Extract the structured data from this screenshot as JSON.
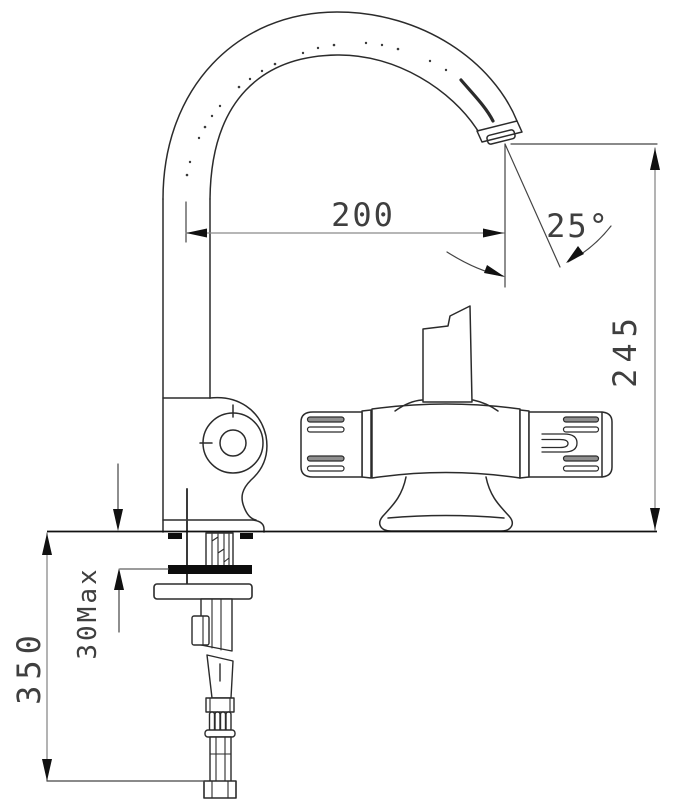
{
  "drawing": {
    "type": "technical-dimension-drawing",
    "subject": "gooseneck kitchen faucet with thermostatic mixer body, side elevation",
    "background_color": "#ffffff",
    "line_color": "#2b2b2b",
    "dimension_line_color": "#8a8a8a",
    "arrow_color": "#111111",
    "text_color": "#3f3f3f",
    "dimensions": {
      "spout_reach": {
        "label": "200"
      },
      "outlet_angle": {
        "label": "25°"
      },
      "spout_height": {
        "label": "245"
      },
      "hose_length": {
        "label": "350"
      },
      "deck_thickness": {
        "label": "30Max"
      }
    }
  }
}
